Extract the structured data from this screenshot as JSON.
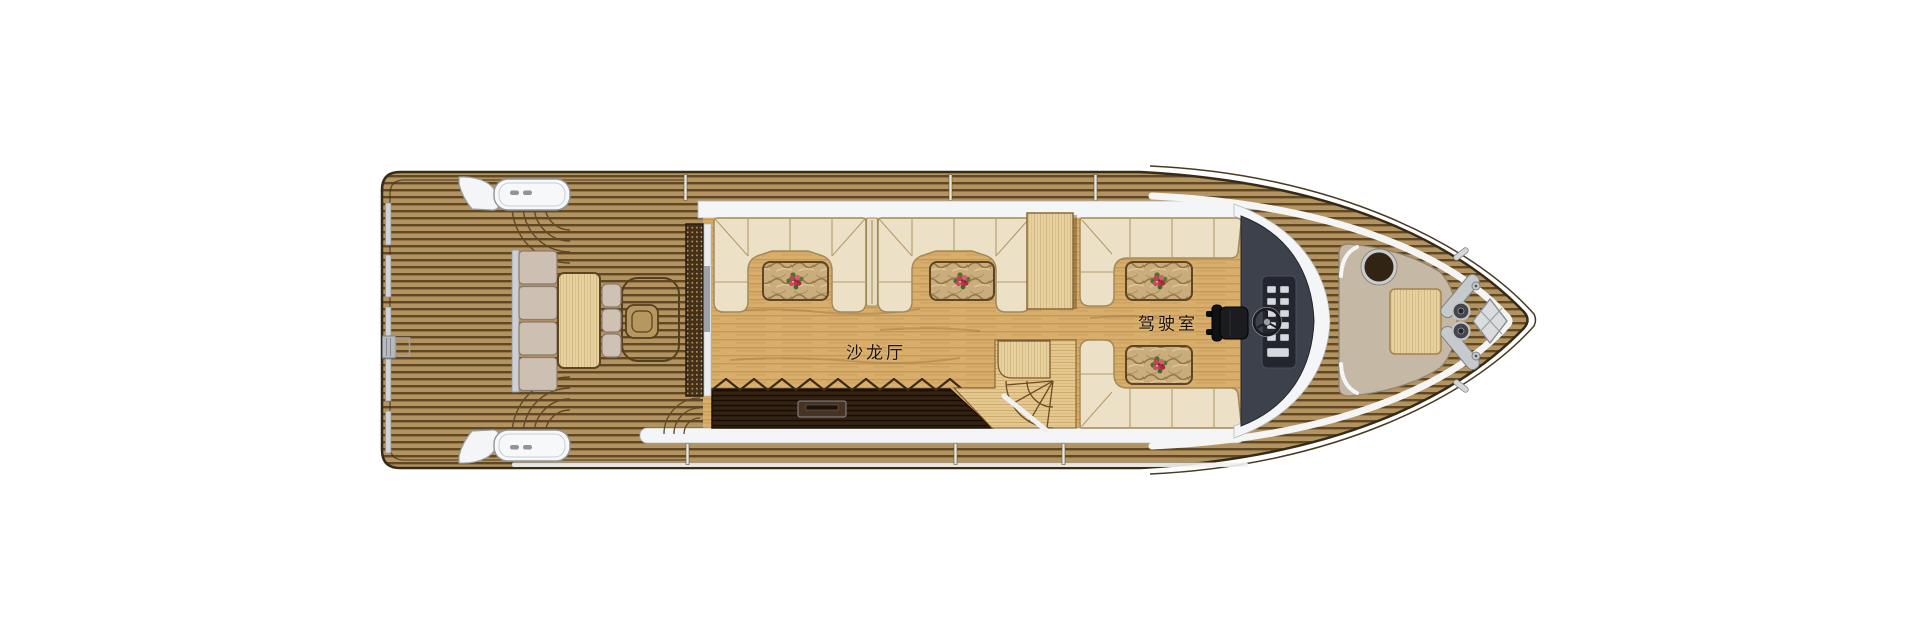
{
  "labels": {
    "salon_hall": "沙龙厅",
    "wheelhouse": "驾驶室"
  },
  "colors": {
    "deck_teak": "#b3935f",
    "deck_plank_line": "#5f4823",
    "hull_outline": "#372b17",
    "cabin_white": "#f4f5f6",
    "salon_floor_oak": "#d9ae6a",
    "cushion_cream": "#ece1c6",
    "cushion_mushroom": "#cdbfb2",
    "wood_maple": "#e8d1a1",
    "bar_espresso": "#2f1f10",
    "marble_table": "#c9ad7d",
    "helm_dash": "#3d414b",
    "sunpad_beige": "#c5b8a5",
    "metal_silver": "#c6cacd",
    "flower_red": "#b73b4c",
    "leaf_green": "#4f7030"
  },
  "icons": {
    "flower_bouquet": "bouquet-icon",
    "steering_wheel": "steering-wheel-icon",
    "anchor_locker": "anchor-locker-hatch-icon",
    "windlass": "anchor-windlass-icon",
    "companionway": "stairs-icon"
  }
}
